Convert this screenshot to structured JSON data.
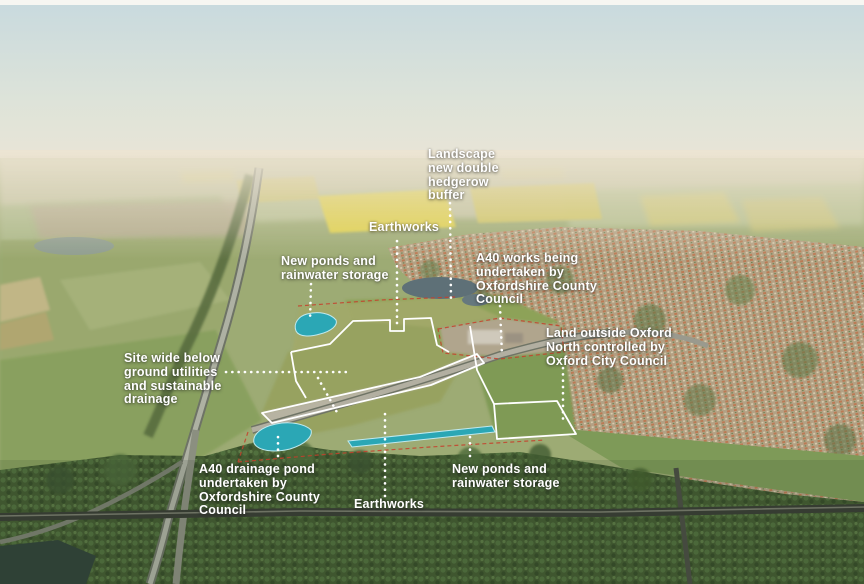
{
  "figure": {
    "type": "annotated-aerial-photograph",
    "subject": "Oxford North development site and surrounding countryside"
  },
  "colors": {
    "pond_teal": "#2ba7b5",
    "pond_edge": "#bfe9ef",
    "site_outline": "#ffffff",
    "boundary_red": "#c6402c",
    "leader_white": "#ffffff",
    "label_text": "#ffffff"
  },
  "annotations": [
    {
      "id": "landscape-hedgerow-buffer",
      "text": "Landscape new double hedgerow buffer"
    },
    {
      "id": "earthworks-north",
      "text": "Earthworks"
    },
    {
      "id": "new-ponds-north",
      "text": "New ponds and rainwater storage"
    },
    {
      "id": "a40-works",
      "text": "A40 works being undertaken by Oxfordshire County Council"
    },
    {
      "id": "land-outside-oxford-north",
      "text": "Land outside Oxford North controlled by Oxford City Council"
    },
    {
      "id": "site-wide-utilities",
      "text": "Site wide below ground utilities and sustainable drainage"
    },
    {
      "id": "a40-drainage-pond",
      "text": "A40 drainage pond undertaken by Oxfordshire County Council"
    },
    {
      "id": "earthworks-south",
      "text": "Earthworks"
    },
    {
      "id": "new-ponds-south",
      "text": "New ponds and rainwater storage"
    }
  ],
  "features": {
    "ponds": [
      "new-pond-north-west",
      "a40-drainage-pond",
      "new-pond-linear-south"
    ],
    "outlines": [
      "site-parcel-outlines-white",
      "planning-boundary-red-dashed"
    ]
  }
}
